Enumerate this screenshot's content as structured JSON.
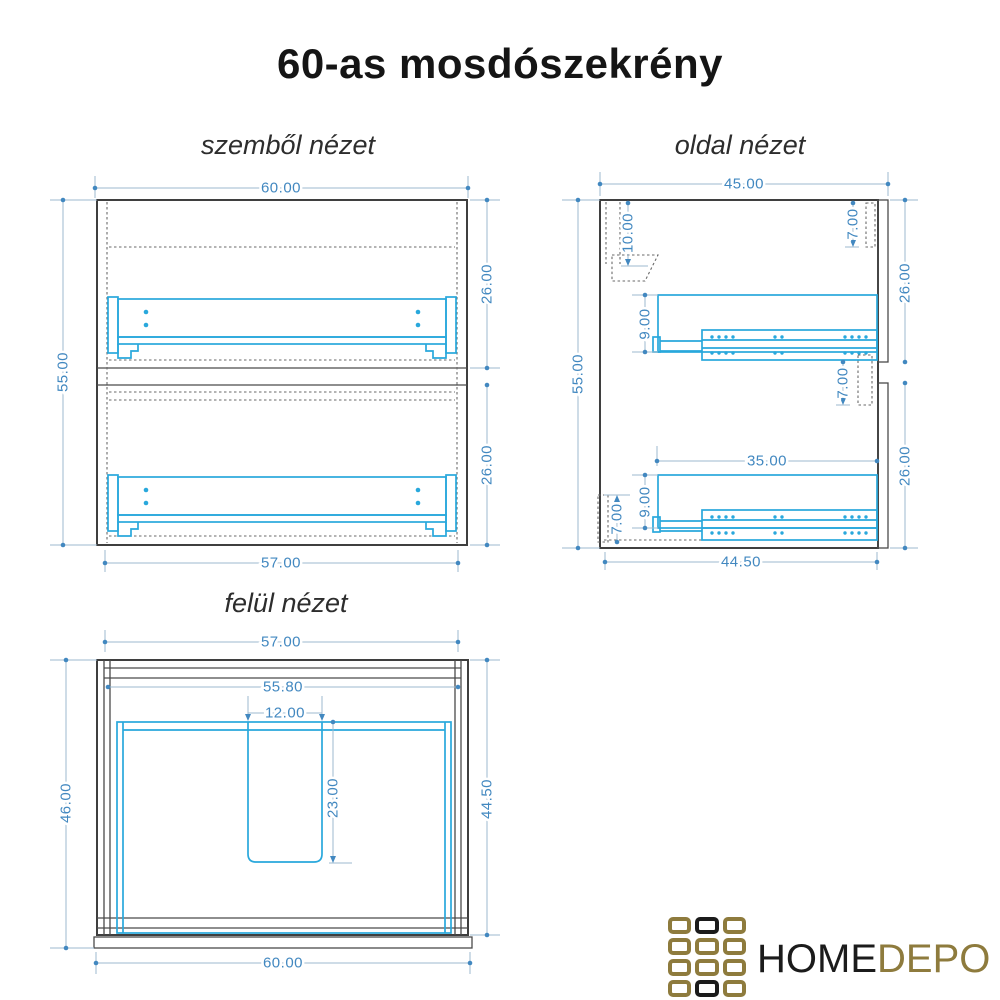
{
  "page": {
    "title": "60-as mosdószekrény",
    "background": "#ffffff"
  },
  "views": {
    "front": {
      "label": "szemből nézet",
      "dims": {
        "overall_width": "60.00",
        "overall_height": "55.00",
        "upper_drawer_height": "26.00",
        "lower_drawer_height": "26.00",
        "carcass_width": "57.00"
      }
    },
    "side": {
      "label": "oldal nézet",
      "dims": {
        "overall_depth": "45.00",
        "overall_height": "55.00",
        "top_inset": "10.00",
        "top_gap": "7.00",
        "upper_front_height": "26.00",
        "lower_front_height": "26.00",
        "upper_rail_height": "9.00",
        "lower_rail_height": "9.00",
        "slide_length": "35.00",
        "mid_gap": "7.00",
        "plinth_height": "7.00",
        "carcass_depth": "44.50"
      }
    },
    "top": {
      "label": "felül nézet",
      "dims": {
        "carcass_width": "57.00",
        "inner_width": "55.80",
        "cutout_width": "12.00",
        "cutout_depth": "23.00",
        "overall_depth": "46.00",
        "carcass_depth": "44.50",
        "front_width": "60.00"
      }
    }
  },
  "logo": {
    "word_primary": "HOME",
    "word_secondary": "DEPO",
    "colors": {
      "gold": "#8e7b3d",
      "dark": "#1b1b1b"
    },
    "grid_pattern": [
      "gold",
      "black",
      "gold",
      "gold",
      "gold",
      "gold",
      "gold",
      "gold",
      "gold",
      "gold",
      "black",
      "gold"
    ]
  },
  "drawing": {
    "colors": {
      "outline": "#3f3f3f",
      "hardware": "#29a8dc",
      "dimension_text": "#4288c0",
      "dimension_line": "#9db9cf"
    }
  }
}
